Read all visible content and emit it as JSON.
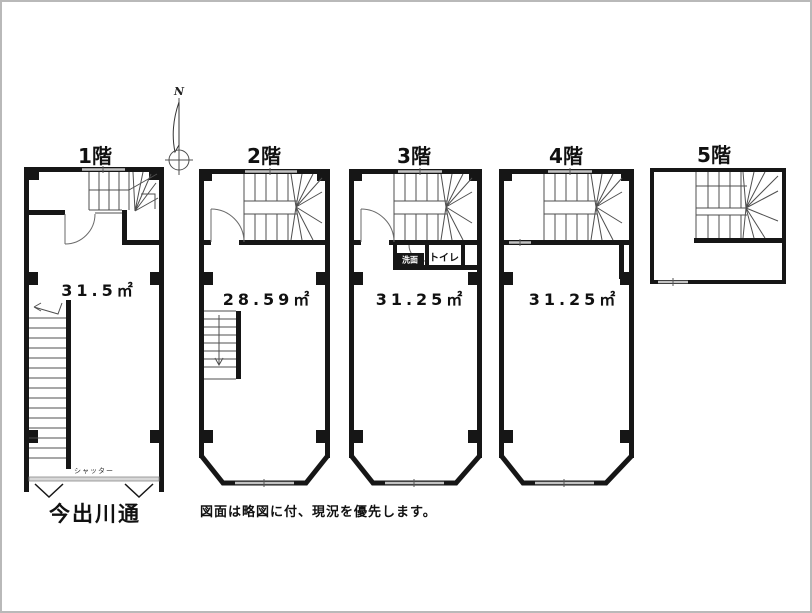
{
  "compass": {
    "north_label": "N"
  },
  "floors": [
    {
      "id": "1f",
      "label": "1階",
      "area": "31.5㎡"
    },
    {
      "id": "2f",
      "label": "2階",
      "area": "28.59㎡"
    },
    {
      "id": "3f",
      "label": "3階",
      "area": "31.25㎡",
      "rooms": {
        "toilet": "トイレ",
        "washroom": "洗面"
      }
    },
    {
      "id": "4f",
      "label": "4階",
      "area": "31.25㎡"
    },
    {
      "id": "5f",
      "label": "5階"
    }
  ],
  "labels": {
    "street": "今出川通",
    "shutter": "シャッター",
    "disclaimer": "図面は略図に付、現況を優先します。"
  },
  "colors": {
    "wall": "#161616",
    "stair_line": "#4f4f4f",
    "window": "#c2c2c2",
    "background": "#ffffff"
  }
}
